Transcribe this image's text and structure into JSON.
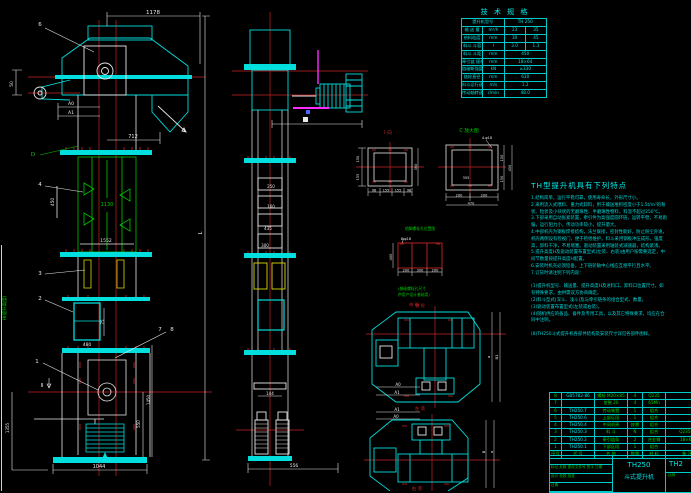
{
  "colors": {
    "bg": "#000000",
    "cyan": "#00dede",
    "green": "#00c800",
    "red": "#c82323",
    "white": "#e8e8e8",
    "yellow": "#d9d900",
    "magenta": "#ff2bff"
  },
  "spec": {
    "title": "技 术 规 格",
    "rows": {
      "r1l": "提升机型号",
      "r1v": "TH 250",
      "r2l": "输 送 量",
      "r2u": "m³/h",
      "r2a": "23",
      "r2b": "35",
      "r3l": "给料粒度",
      "r3u": "mm",
      "r3a": "30",
      "r3b": "45",
      "r4l": "料斗 斗容",
      "r4u": "l",
      "r4a": "3.0",
      "r4b": "1.3",
      "r5l": "料斗 斗距",
      "r5u": "mm",
      "r5v": "450",
      "r6l": "牵引链 规格",
      "r6u": "mm",
      "r6v": "18×64",
      "r7l": "链破断强度",
      "r7u": "kN",
      "r7v": "≥330",
      "r8l": "链轮直径",
      "r8u": "mm",
      "r8v": "630",
      "r9l": "料斗运行速度",
      "r9u": "m/s",
      "r9v": "1.2",
      "r10l": "传动轴转速",
      "r10u": "r/min",
      "r10v": "48.0"
    }
  },
  "notes": {
    "title": "TH型提升机具有下列特点",
    "lines": [
      "1.结构简单，运行平稳可靠，使用寿命长，外形尺寸小。",
      "2.采用流入式喂料、重力式卸料，用于输送堆积密度小于1.5t/m³的粉",
      "  状、粒状及小块状的无磨琢性、半磨琢性物料，料温不超过250℃。",
      "3.下部采用自动张紧装置，牵引件为高强度圆环链，运转平稳，不易跑",
      "  偏，运行阻力小，传动功率较小，提升量大。",
      "4.中部机壳为钢板焊接结构，法兰联接，密封性能好，防止粉尘外逸，",
      "  机壳两侧设有检视门，便于检修维护。料斗采用钢板冲压成形，强度",
      "  高，卸料干净，不易堵塞。驱动装置采用轴装式减速器，结构紧凑。",
      "5.提升高度H及驱动装置布置型式(左装、右装)由用户按需要选定，中",
      "  间节数量按提升高度H配置。",
      "6.安装时机壳必须铅垂，上下链轮轴中心线应互相平行且水平。",
      "7.订货时请注明下列内容：",
      "",
      "(1)提升机型号、输送量、提升高度H及进料口、卸料口位置尺寸，如",
      "   有特殊要求，由供需双方协商确定。",
      "(2)料斗型式(深斗、浅斗)及与牵引链条的组合型式、数量。",
      "(3)驱动装置布置型式(左装或右装)。",
      "(4)随机供应的备品、备件及专用工具，以及其它特殊要求，均应在合",
      "   同中注明。",
      "",
      "(8)TH250斗式提升机各部件结构及安装尺寸详见各部件图样。"
    ]
  },
  "parts": {
    "header": [
      "序号",
      "代  号",
      "名  称",
      "数量",
      "材 料",
      "备  注"
    ],
    "rows": [
      [
        "8",
        "GB5782-86",
        "螺栓 M20×85",
        "4",
        "Q235",
        ""
      ],
      [
        "7",
        "",
        "垫圈 20",
        "4",
        "65Mn",
        ""
      ],
      [
        "6",
        "TH250.7",
        "传动装置",
        "1",
        "组合",
        ""
      ],
      [
        "5",
        "TH250.6",
        "上部区段",
        "1",
        "组合",
        ""
      ],
      [
        "4",
        "TH250.4",
        "中间机壳",
        "按需",
        "组合",
        ""
      ],
      [
        "3",
        "TH250.3",
        "料  斗",
        "N",
        "组合",
        "Q235-A"
      ],
      [
        "2",
        "TH250.2",
        "牵引链条",
        "2",
        "合金钢",
        "18×64"
      ],
      [
        "1",
        "TH250.1",
        "下部区段",
        "1",
        "组合",
        ""
      ]
    ]
  },
  "titleblock": {
    "rev_line": "标记 处数 更改文件号 签字 日期",
    "sig_line": "设计    校核    批准",
    "date_line": "日期",
    "model": "TH250",
    "name": "斗式提升机",
    "right": "TH2",
    "scale_label": "比例",
    "scale_value": "1:10"
  },
  "main_view": {
    "dim_1178": "1178",
    "dim_712": "712",
    "dim_a0": "A0",
    "dim_a1": "A1",
    "dim_50": "50",
    "dim_1130": "1130",
    "dim_450": "450",
    "dim_1552": "1552",
    "dim_480": "480",
    "dim_75": "75",
    "dim_1044": "1044",
    "dim_L": "L",
    "dim_1450": "1450",
    "dim_550": "550",
    "dim_1355": "1355",
    "height_label": "H(提升高度)",
    "section2": "Ⅱ",
    "letter_d": "D",
    "bal1": "1",
    "bal2": "2",
    "bal3": "3",
    "bal4": "4",
    "bal6": "6",
    "bal7": "7",
    "bal8": "8"
  },
  "side_view": {
    "dim_250": "250",
    "dim_160": "160",
    "dim_435": "435",
    "dim_300": "300",
    "dim_144": "144",
    "dim_556": "556"
  },
  "detail_i": {
    "caption": "Ⅰ 向",
    "d150": "150",
    "d155": "155",
    "d360": "360",
    "w1": "98",
    "w2": "155",
    "w3": "155",
    "w4": "98"
  },
  "detail_c": {
    "caption": "C 放大图",
    "callout": "4-φ18",
    "d355": "355",
    "b200a": "200",
    "b200b": "200",
    "b470": "470",
    "r150a": "150",
    "r150b": "150",
    "r450": "450"
  },
  "anchor": {
    "title": "地脚螺栓孔位置图",
    "callout": "8-φ18",
    "d200a": "200",
    "d300": "300",
    "d200b": "200",
    "d400": "400",
    "note1": "(基础螺栓孔尺寸",
    "note2": "供用户设计基础用)",
    "caption": "俯 视"
  },
  "plan1": {
    "caption_top": "俯 视",
    "caption": "左 装",
    "da0": "A0",
    "da1": "A1",
    "da": "a",
    "db1": "B1"
  },
  "plan2": {
    "caption": "右 装",
    "da1": "A1",
    "da0": "A0",
    "db": "B",
    "da": "a"
  }
}
